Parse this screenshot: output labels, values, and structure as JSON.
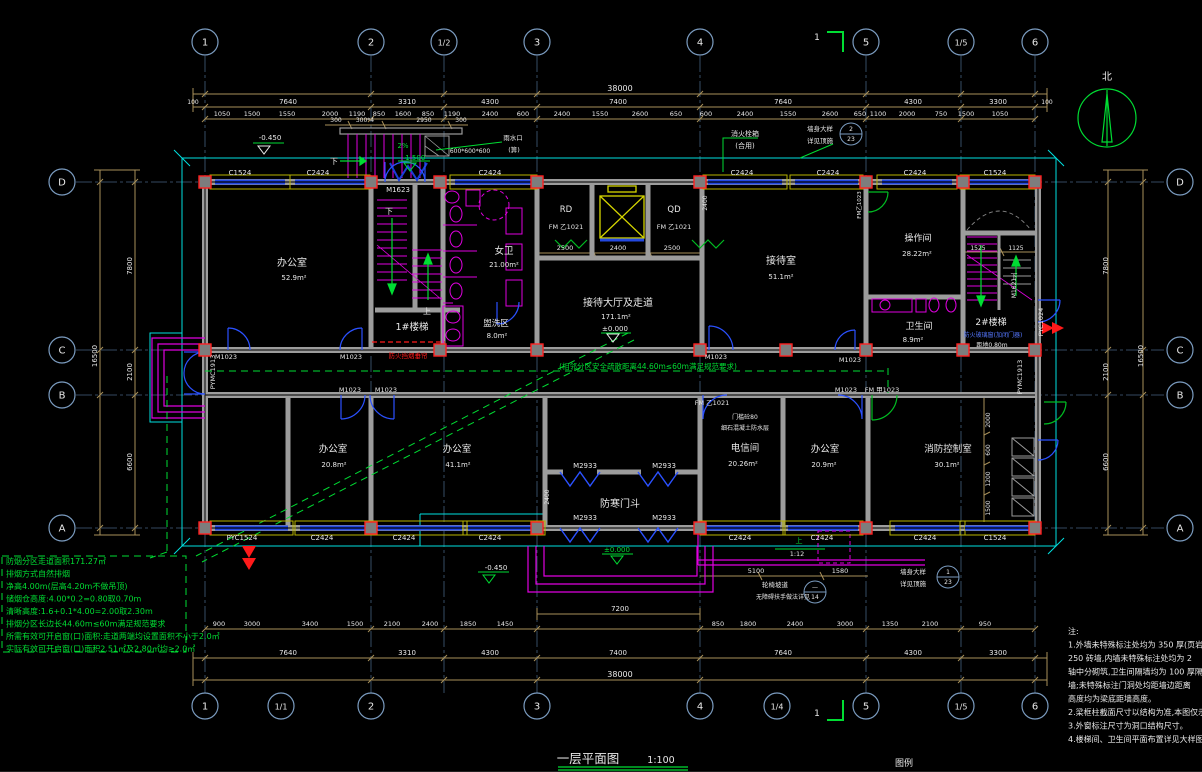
{
  "drawing": {
    "title": "一层平面图",
    "scale": "1:100",
    "legend": "图例",
    "north": "北",
    "section_mark": "1"
  },
  "colors": {
    "axis": "#44617f",
    "bubble": "#7b9cc0",
    "dim": "#a8905a",
    "wall": "#9c9c9c",
    "window": "#2247e0",
    "sill": "#b8b400",
    "outline": "#00e0e0",
    "fixture": "#e000e0",
    "green": "#00dd33",
    "red": "#ff1a1a",
    "column_edge": "#ff2020",
    "text": "#e8e8e8",
    "door_alt": "#00bb22",
    "elevator": "#d6d600"
  },
  "axes": {
    "top": [
      {
        "label": "1",
        "x": 205
      },
      {
        "label": "2",
        "x": 371
      },
      {
        "label": "1/2",
        "x": 444
      },
      {
        "label": "3",
        "x": 537
      },
      {
        "label": "4",
        "x": 700
      },
      {
        "label": "5",
        "x": 866
      },
      {
        "label": "1/5",
        "x": 961
      },
      {
        "label": "6",
        "x": 1035
      }
    ],
    "bottom": [
      {
        "label": "1",
        "x": 205
      },
      {
        "label": "1/1",
        "x": 281
      },
      {
        "label": "2",
        "x": 371
      },
      {
        "label": "3",
        "x": 537
      },
      {
        "label": "4",
        "x": 700
      },
      {
        "label": "1/4",
        "x": 777
      },
      {
        "label": "5",
        "x": 866
      },
      {
        "label": "1/5",
        "x": 961
      },
      {
        "label": "6",
        "x": 1035
      }
    ],
    "left": [
      {
        "label": "D",
        "y": 182
      },
      {
        "label": "C",
        "y": 350
      },
      {
        "label": "B",
        "y": 395
      },
      {
        "label": "A",
        "y": 528
      }
    ],
    "right": [
      {
        "label": "D",
        "y": 182
      },
      {
        "label": "C",
        "y": 350
      },
      {
        "label": "B",
        "y": 395
      },
      {
        "label": "A",
        "y": 528
      }
    ]
  },
  "windows": {
    "top": [
      {
        "x1": 215,
        "x2": 285,
        "label": "C1524",
        "lx": 240
      },
      {
        "x1": 295,
        "x2": 365,
        "label": "C2424",
        "lx": 318
      },
      {
        "x1": 455,
        "x2": 532,
        "label": "C2424",
        "lx": 490
      },
      {
        "x1": 708,
        "x2": 782,
        "label": "C2424",
        "lx": 742
      },
      {
        "x1": 795,
        "x2": 858,
        "label": "C2424",
        "lx": 828
      },
      {
        "x1": 882,
        "x2": 952,
        "label": "C2424",
        "lx": 915
      },
      {
        "x1": 965,
        "x2": 1030,
        "label": "C1524",
        "lx": 995
      }
    ],
    "bottom": [
      {
        "x1": 215,
        "x2": 288,
        "label": "PYC1524",
        "lx": 242
      },
      {
        "x1": 300,
        "x2": 368,
        "label": "C2424",
        "lx": 322
      },
      {
        "x1": 378,
        "x2": 462,
        "label": "C2424",
        "lx": 404
      },
      {
        "x1": 468,
        "x2": 540,
        "label": "C2424",
        "lx": 490
      },
      {
        "x1": 705,
        "x2": 780,
        "label": "C2424",
        "lx": 740
      },
      {
        "x1": 788,
        "x2": 858,
        "label": "C2424",
        "lx": 822
      },
      {
        "x1": 895,
        "x2": 960,
        "label": "C2424",
        "lx": 925
      },
      {
        "x1": 965,
        "x2": 1030,
        "label": "C1524",
        "lx": 995
      }
    ]
  },
  "columns": [
    {
      "y": 182,
      "xs": [
        205,
        371,
        440,
        537,
        700,
        866,
        963,
        1035
      ]
    },
    {
      "y": 350,
      "xs": [
        205,
        440,
        537,
        700,
        786,
        866,
        963,
        1035
      ]
    },
    {
      "y": 528,
      "xs": [
        205,
        371,
        537,
        700,
        866,
        1035
      ]
    }
  ],
  "labels": [
    {
      "t": "38000",
      "x": 620,
      "y": 91,
      "s": 8
    },
    {
      "t": "100",
      "x": 193,
      "y": 104,
      "s": 6
    },
    {
      "t": "7640",
      "x": 288,
      "y": 104,
      "s": 7
    },
    {
      "t": "3310",
      "x": 407,
      "y": 104,
      "s": 7
    },
    {
      "t": "4300",
      "x": 490,
      "y": 104,
      "s": 7
    },
    {
      "t": "7400",
      "x": 618,
      "y": 104,
      "s": 7
    },
    {
      "t": "7640",
      "x": 783,
      "y": 104,
      "s": 7
    },
    {
      "t": "4300",
      "x": 913,
      "y": 104,
      "s": 7
    },
    {
      "t": "3300",
      "x": 998,
      "y": 104,
      "s": 7
    },
    {
      "t": "100",
      "x": 1047,
      "y": 104,
      "s": 6
    },
    {
      "t": "1050",
      "x": 222,
      "y": 116,
      "s": 6.5
    },
    {
      "t": "1500",
      "x": 252,
      "y": 116,
      "s": 6.5
    },
    {
      "t": "1550",
      "x": 287,
      "y": 116,
      "s": 6.5
    },
    {
      "t": "2000",
      "x": 330,
      "y": 116,
      "s": 6.5
    },
    {
      "t": "1190",
      "x": 357,
      "y": 116,
      "s": 6.5
    },
    {
      "t": "850",
      "x": 379,
      "y": 116,
      "s": 6.5
    },
    {
      "t": "1600",
      "x": 403,
      "y": 116,
      "s": 6.5
    },
    {
      "t": "850",
      "x": 428,
      "y": 116,
      "s": 6.5
    },
    {
      "t": "1190",
      "x": 452,
      "y": 116,
      "s": 6.5
    },
    {
      "t": "2400",
      "x": 490,
      "y": 116,
      "s": 6.5
    },
    {
      "t": "600",
      "x": 523,
      "y": 116,
      "s": 6.5
    },
    {
      "t": "2400",
      "x": 562,
      "y": 116,
      "s": 6.5
    },
    {
      "t": "1550",
      "x": 600,
      "y": 116,
      "s": 6.5
    },
    {
      "t": "2600",
      "x": 640,
      "y": 116,
      "s": 6.5
    },
    {
      "t": "650",
      "x": 676,
      "y": 116,
      "s": 6.5
    },
    {
      "t": "600",
      "x": 706,
      "y": 116,
      "s": 6.5
    },
    {
      "t": "2400",
      "x": 745,
      "y": 116,
      "s": 6.5
    },
    {
      "t": "1550",
      "x": 788,
      "y": 116,
      "s": 6.5
    },
    {
      "t": "2600",
      "x": 830,
      "y": 116,
      "s": 6.5
    },
    {
      "t": "650",
      "x": 860,
      "y": 116,
      "s": 6.5
    },
    {
      "t": "1100",
      "x": 878,
      "y": 116,
      "s": 6.5
    },
    {
      "t": "2000",
      "x": 907,
      "y": 116,
      "s": 6.5
    },
    {
      "t": "750",
      "x": 941,
      "y": 116,
      "s": 6.5
    },
    {
      "t": "1500",
      "x": 966,
      "y": 116,
      "s": 6.5
    },
    {
      "t": "1050",
      "x": 1000,
      "y": 116,
      "s": 6.5
    },
    {
      "t": "900",
      "x": 219,
      "y": 626,
      "s": 6.5
    },
    {
      "t": "3000",
      "x": 252,
      "y": 626,
      "s": 6.5
    },
    {
      "t": "3400",
      "x": 310,
      "y": 626,
      "s": 6.5
    },
    {
      "t": "1500",
      "x": 355,
      "y": 626,
      "s": 6.5
    },
    {
      "t": "2100",
      "x": 392,
      "y": 626,
      "s": 6.5
    },
    {
      "t": "2400",
      "x": 430,
      "y": 626,
      "s": 6.5
    },
    {
      "t": "1850",
      "x": 468,
      "y": 626,
      "s": 6.5
    },
    {
      "t": "1450",
      "x": 505,
      "y": 626,
      "s": 6.5
    },
    {
      "t": "850",
      "x": 718,
      "y": 626,
      "s": 6.5
    },
    {
      "t": "1800",
      "x": 748,
      "y": 626,
      "s": 6.5
    },
    {
      "t": "2400",
      "x": 795,
      "y": 626,
      "s": 6.5
    },
    {
      "t": "3000",
      "x": 845,
      "y": 626,
      "s": 6.5
    },
    {
      "t": "1350",
      "x": 890,
      "y": 626,
      "s": 6.5
    },
    {
      "t": "2100",
      "x": 930,
      "y": 626,
      "s": 6.5
    },
    {
      "t": "950",
      "x": 985,
      "y": 626,
      "s": 6.5
    },
    {
      "t": "7200",
      "x": 620,
      "y": 611,
      "s": 7
    },
    {
      "t": "7640",
      "x": 288,
      "y": 655,
      "s": 7
    },
    {
      "t": "3310",
      "x": 407,
      "y": 655,
      "s": 7
    },
    {
      "t": "4300",
      "x": 490,
      "y": 655,
      "s": 7
    },
    {
      "t": "7400",
      "x": 618,
      "y": 655,
      "s": 7
    },
    {
      "t": "7640",
      "x": 783,
      "y": 655,
      "s": 7
    },
    {
      "t": "4300",
      "x": 913,
      "y": 655,
      "s": 7
    },
    {
      "t": "3300",
      "x": 998,
      "y": 655,
      "s": 7
    },
    {
      "t": "38000",
      "x": 620,
      "y": 677,
      "s": 8
    },
    {
      "t": "16500",
      "x": 97,
      "y": 356,
      "s": 7,
      "r": -90
    },
    {
      "t": "7800",
      "x": 132,
      "y": 266,
      "s": 7,
      "r": -90
    },
    {
      "t": "2100",
      "x": 132,
      "y": 372,
      "s": 7,
      "r": -90
    },
    {
      "t": "6600",
      "x": 132,
      "y": 462,
      "s": 7,
      "r": -90
    },
    {
      "t": "7800",
      "x": 1108,
      "y": 266,
      "s": 7,
      "r": -90
    },
    {
      "t": "2100",
      "x": 1108,
      "y": 372,
      "s": 7,
      "r": -90
    },
    {
      "t": "6600",
      "x": 1108,
      "y": 462,
      "s": 7,
      "r": -90
    },
    {
      "t": "16500",
      "x": 1143,
      "y": 356,
      "s": 7,
      "r": -90
    },
    {
      "t": "2000",
      "x": 990,
      "y": 420,
      "s": 6,
      "r": -90
    },
    {
      "t": "600",
      "x": 990,
      "y": 450,
      "s": 6,
      "r": -90
    },
    {
      "t": "1200",
      "x": 990,
      "y": 479,
      "s": 6,
      "r": -90
    },
    {
      "t": "1500",
      "x": 990,
      "y": 508,
      "s": 6,
      "r": -90
    },
    {
      "t": "2400",
      "x": 549,
      "y": 497,
      "s": 6,
      "r": -90
    },
    {
      "t": "2400",
      "x": 707,
      "y": 203,
      "s": 6,
      "r": -90
    },
    {
      "t": "2500",
      "x": 565,
      "y": 250,
      "s": 6.5
    },
    {
      "t": "2400",
      "x": 618,
      "y": 250,
      "s": 6.5
    },
    {
      "t": "2500",
      "x": 672,
      "y": 250,
      "s": 6.5
    },
    {
      "t": "1525",
      "x": 978,
      "y": 250,
      "s": 6
    },
    {
      "t": "1125",
      "x": 1016,
      "y": 250,
      "s": 6
    },
    {
      "t": "300",
      "x": 336,
      "y": 122,
      "s": 6
    },
    {
      "t": "300*4",
      "x": 365,
      "y": 122,
      "s": 6
    },
    {
      "t": "2950",
      "x": 424,
      "y": 122,
      "s": 6
    },
    {
      "t": "300",
      "x": 461,
      "y": 122,
      "s": 6
    },
    {
      "t": "5100",
      "x": 756,
      "y": 573,
      "s": 6.5
    },
    {
      "t": "1580",
      "x": 840,
      "y": 573,
      "s": 6.5
    },
    {
      "t": "办公室",
      "x": 292,
      "y": 266,
      "s": 10
    },
    {
      "t": "52.9m²",
      "x": 294,
      "y": 280,
      "s": 7
    },
    {
      "t": "1#楼梯",
      "x": 412,
      "y": 330,
      "s": 9.5
    },
    {
      "t": "下",
      "x": 389,
      "y": 214,
      "s": 8
    },
    {
      "t": "上",
      "x": 427,
      "y": 314,
      "s": 8
    },
    {
      "t": "女卫",
      "x": 504,
      "y": 254,
      "s": 9.5
    },
    {
      "t": "21.00m²",
      "x": 504,
      "y": 267,
      "s": 7
    },
    {
      "t": "盥洗区",
      "x": 496,
      "y": 326,
      "s": 8.5
    },
    {
      "t": "8.0m²",
      "x": 497,
      "y": 338,
      "s": 7
    },
    {
      "t": "RD",
      "x": 566,
      "y": 212,
      "s": 8.5
    },
    {
      "t": "FM 乙1021",
      "x": 566,
      "y": 229,
      "s": 6.5
    },
    {
      "t": "QD",
      "x": 674,
      "y": 212,
      "s": 8.5
    },
    {
      "t": "FM 乙1021",
      "x": 674,
      "y": 229,
      "s": 6.5
    },
    {
      "t": "接待大厅及走道",
      "x": 618,
      "y": 306,
      "s": 10
    },
    {
      "t": "171.1m²",
      "x": 616,
      "y": 319,
      "s": 7
    },
    {
      "t": "±0.000",
      "x": 615,
      "y": 331,
      "s": 7
    },
    {
      "t": "接待室",
      "x": 781,
      "y": 264,
      "s": 10
    },
    {
      "t": "51.1m²",
      "x": 781,
      "y": 279,
      "s": 7
    },
    {
      "t": "操作间",
      "x": 918,
      "y": 241,
      "s": 9
    },
    {
      "t": "28.22m²",
      "x": 917,
      "y": 256,
      "s": 7
    },
    {
      "t": "卫生间",
      "x": 919,
      "y": 329,
      "s": 9
    },
    {
      "t": "8.9m²",
      "x": 913,
      "y": 342,
      "s": 7
    },
    {
      "t": "2#楼梯",
      "x": 991,
      "y": 325,
      "s": 9
    },
    {
      "t": "防火玻璃窗(加闭门器)",
      "x": 993,
      "y": 337,
      "s": 6,
      "c": "#5577ff"
    },
    {
      "t": "距地0.80m",
      "x": 992,
      "y": 347,
      "s": 6
    },
    {
      "t": "下",
      "x": 1014,
      "y": 279,
      "s": 7
    },
    {
      "t": "M1623",
      "x": 398,
      "y": 192,
      "s": 7
    },
    {
      "t": "电信间",
      "x": 745,
      "y": 451,
      "s": 9.5
    },
    {
      "t": "20.26m²",
      "x": 743,
      "y": 466,
      "s": 7
    },
    {
      "t": "办公室",
      "x": 825,
      "y": 452,
      "s": 9.5
    },
    {
      "t": "20.9m²",
      "x": 824,
      "y": 467,
      "s": 7
    },
    {
      "t": "办公室",
      "x": 333,
      "y": 452,
      "s": 9.5
    },
    {
      "t": "20.8m²",
      "x": 334,
      "y": 467,
      "s": 7
    },
    {
      "t": "办公室",
      "x": 457,
      "y": 452,
      "s": 9.5
    },
    {
      "t": "41.1m²",
      "x": 458,
      "y": 467,
      "s": 7
    },
    {
      "t": "消防控制室",
      "x": 948,
      "y": 452,
      "s": 9.5
    },
    {
      "t": "30.1m²",
      "x": 947,
      "y": 467,
      "s": 7
    },
    {
      "t": "防寒门斗",
      "x": 620,
      "y": 507,
      "s": 10
    },
    {
      "t": "M2933",
      "x": 585,
      "y": 468,
      "s": 7
    },
    {
      "t": "M2933",
      "x": 664,
      "y": 468,
      "s": 7
    },
    {
      "t": "M2933",
      "x": 585,
      "y": 520,
      "s": 7
    },
    {
      "t": "M2933",
      "x": 664,
      "y": 520,
      "s": 7
    },
    {
      "t": "±0.000",
      "x": 617,
      "y": 552,
      "s": 7,
      "c": "#00dd33"
    },
    {
      "t": "-0.450",
      "x": 270,
      "y": 140,
      "s": 7
    },
    {
      "t": "-0.450",
      "x": 496,
      "y": 570,
      "s": 7
    },
    {
      "t": "-1.500",
      "x": 414,
      "y": 160,
      "s": 7,
      "c": "#00dd33"
    },
    {
      "t": "2%",
      "x": 403,
      "y": 148,
      "s": 7,
      "c": "#00dd33"
    },
    {
      "t": "下",
      "x": 334,
      "y": 164,
      "s": 8
    },
    {
      "t": "雨水口",
      "x": 513,
      "y": 140,
      "s": 6.5
    },
    {
      "t": "(箅)",
      "x": 514,
      "y": 152,
      "s": 6.5
    },
    {
      "t": "600*600*600",
      "x": 470,
      "y": 153,
      "s": 6
    },
    {
      "t": "消火栓箱",
      "x": 745,
      "y": 136,
      "s": 7
    },
    {
      "t": "(合用)",
      "x": 745,
      "y": 148,
      "s": 7
    },
    {
      "t": "墙身大样",
      "x": 820,
      "y": 131,
      "s": 6.5
    },
    {
      "t": "详见顶施",
      "x": 820,
      "y": 143,
      "s": 6.5
    },
    {
      "t": "2",
      "x": 851,
      "y": 131,
      "s": 6
    },
    {
      "t": "23",
      "x": 851,
      "y": 141,
      "s": 6
    },
    {
      "t": "墙身大样",
      "x": 913,
      "y": 574,
      "s": 6.5
    },
    {
      "t": "详见顶施",
      "x": 913,
      "y": 586,
      "s": 6.5
    },
    {
      "t": "1",
      "x": 948,
      "y": 574,
      "s": 6
    },
    {
      "t": "23",
      "x": 948,
      "y": 584,
      "s": 6
    },
    {
      "t": "轮椅坡道",
      "x": 775,
      "y": 587,
      "s": 6.5
    },
    {
      "t": "无障碍扶手做法详见",
      "x": 783,
      "y": 599,
      "s": 6
    },
    {
      "t": "—",
      "x": 815,
      "y": 589,
      "s": 6
    },
    {
      "t": "14",
      "x": 815,
      "y": 599,
      "s": 6
    },
    {
      "t": "上",
      "x": 799,
      "y": 543,
      "s": 7,
      "c": "#00dd33"
    },
    {
      "t": "1:12",
      "x": 797,
      "y": 556,
      "s": 6.5
    },
    {
      "t": "(相邻分区安全疏散距离44.60m≤60m满足规范要求)",
      "x": 648,
      "y": 369,
      "s": 7.5,
      "c": "#00dd33"
    },
    {
      "t": "防火挡烟垂帘",
      "x": 408,
      "y": 358,
      "s": 6.5,
      "c": "#ff1a1a"
    },
    {
      "t": "M1023",
      "x": 226,
      "y": 359,
      "s": 6.5
    },
    {
      "t": "M1023",
      "x": 351,
      "y": 359,
      "s": 6.5
    },
    {
      "t": "M1023",
      "x": 716,
      "y": 359,
      "s": 6.5
    },
    {
      "t": "M1023",
      "x": 850,
      "y": 362,
      "s": 6.5
    },
    {
      "t": "M1023",
      "x": 350,
      "y": 392,
      "s": 6.5
    },
    {
      "t": "M1023",
      "x": 386,
      "y": 392,
      "s": 6.5
    },
    {
      "t": "M1023",
      "x": 846,
      "y": 392,
      "s": 6.5
    },
    {
      "t": "FM 甲1023",
      "x": 882,
      "y": 392,
      "s": 6.5
    },
    {
      "t": "FM 乙1021",
      "x": 712,
      "y": 405,
      "s": 6.5
    },
    {
      "t": "门槛砼80",
      "x": 745,
      "y": 419,
      "s": 6
    },
    {
      "t": "细石混凝土防水层",
      "x": 745,
      "y": 430,
      "s": 6
    },
    {
      "t": "PYMC1913",
      "x": 215,
      "y": 372,
      "s": 6.5,
      "r": -90
    },
    {
      "t": "PYC1024",
      "x": 1043,
      "y": 322,
      "s": 6.5,
      "r": -90
    },
    {
      "t": "PYMC1913",
      "x": 1022,
      "y": 377,
      "s": 6.5,
      "r": -90
    },
    {
      "t": "M1621",
      "x": 1016,
      "y": 288,
      "s": 6,
      "r": -90
    },
    {
      "t": "FM乙1023",
      "x": 861,
      "y": 205,
      "s": 5.5,
      "r": -90
    }
  ],
  "notes": {
    "heading_lines": [
      "注:",
      "1.外墙未特殊标注处均为 350 厚(页岩",
      "250 砖墙,内墙未特殊标注处均为 2",
      "轴中分砌筑,卫生间隔墙均为 100 厚隔",
      "墙;未特殊标注门洞处均距墙边距离",
      "高度均为梁底距墙高度。",
      "2.梁框柱截面尺寸以结构为准,本图仅示意。",
      "3.外窗标注尺寸为洞口结构尺寸。",
      "4.楼梯间、卫生间平面布置详见大样图。"
    ]
  },
  "smoke_note": {
    "lines": [
      "防烟分区走道面积171.27㎡",
      "排烟方式自然排烟",
      "净高4.00m(层高4.20m不做吊顶)",
      "储烟仓高度:4.00*0.2=0.80取0.70m",
      "清晰高度:1.6+0.1*4.00=2.00取2.30m",
      "排烟分区长边长44.60m≤60m满足规范要求",
      "所需有效可开启窗(口)面积:走道两端均设置面积不小于2.0㎡",
      "实际有效可开启窗(口)面积2.51㎡及2.80㎡均≥2.0㎡"
    ]
  }
}
